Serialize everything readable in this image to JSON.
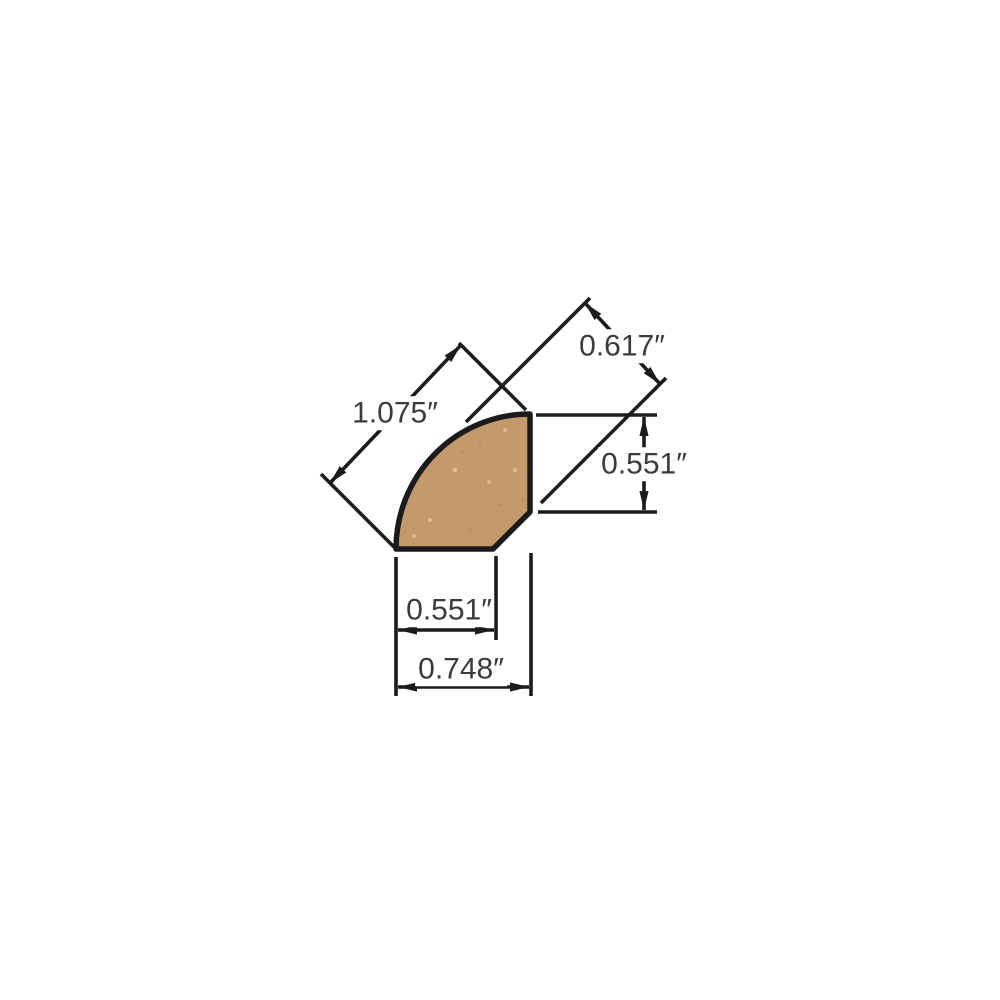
{
  "figure": {
    "shape_name": "quarter-round-moulding-cross-section",
    "background_color": "#ffffff",
    "wood_fill_color": "#c59a6b",
    "outline_color": "#1b1b1b",
    "dimension_line_color": "#1b1b1b",
    "label_text_color": "#3b3b3b",
    "units": "inches"
  },
  "dimensions": {
    "diagonal_back": {
      "label": "1.075″",
      "inches": 1.075
    },
    "angled_face": {
      "label": "0.617″",
      "inches": 0.617
    },
    "right_height": {
      "label": "0.551″",
      "inches": 0.551
    },
    "bottom_width": {
      "label": "0.551″",
      "inches": 0.551
    },
    "overall_width": {
      "label": "0.748″",
      "inches": 0.748
    }
  }
}
